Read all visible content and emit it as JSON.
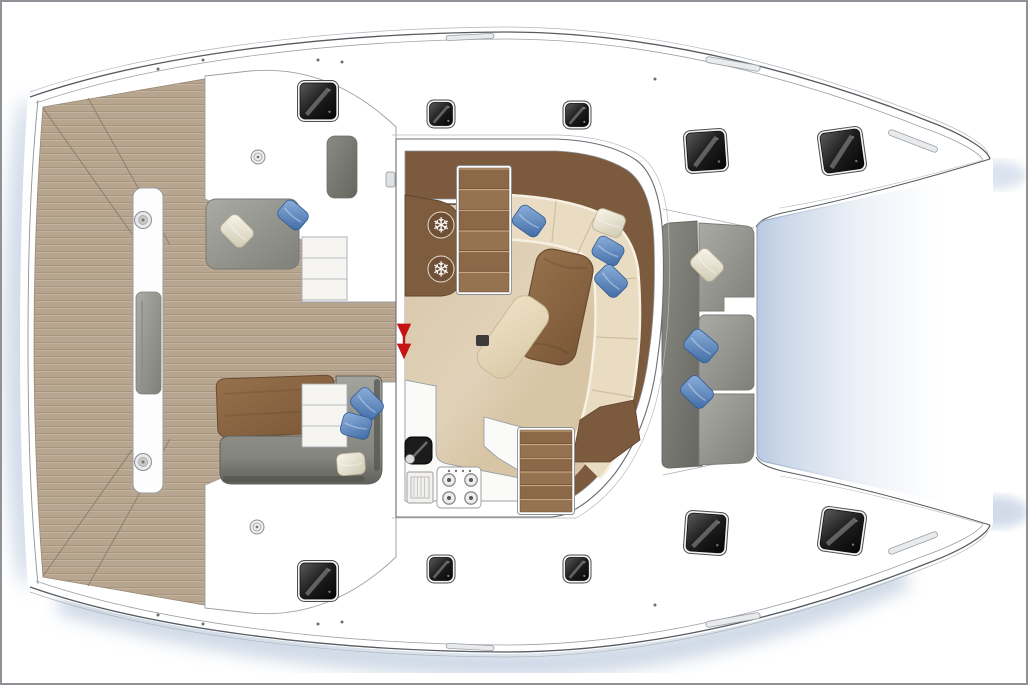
{
  "meta": {
    "title": "catamaran-deck-floor-plan",
    "view": "top-down plan, bow to the right",
    "canvas": {
      "width": 1028,
      "height": 685,
      "frame_color": "#8e9296"
    }
  },
  "palette": {
    "hull_white": "#ffffff",
    "outline_dark": "#565b60",
    "outline_soft": "#9aa0a6",
    "outline_faint": "#b6bbc0",
    "teak": "#b7a58f",
    "teak_line": "#a5947e",
    "teak_seam": "#8f7f6b",
    "salon_floor": "#d8c5a5",
    "wood_band": "#7b5a3d",
    "wood_cabinet": "#7e5d3f",
    "table_wood_hi": "#96714c",
    "table_wood_lo": "#7a5737",
    "step_wood": "#8d6a47",
    "step_wood_dark": "#6a4c32",
    "sofa_cream": "#e9dcc2",
    "sofa_piping": "#f7f1e3",
    "sofa_seam": "#cfbf9f",
    "gray_seat_hi": "#aaaba4",
    "gray_seat_lo": "#7f807a",
    "gray_back_hi": "#8a8b84",
    "gray_back_lo": "#65665f",
    "pillow_blue_hi": "#8fb2dd",
    "pillow_blue_lo": "#3e69a4",
    "pillow_white_hi": "#faf6ea",
    "pillow_white_lo": "#cfc9b2",
    "tramp_edge": "#b9c9e0",
    "water_shadow": "#a9bbd4",
    "hatch_frame": "#f0f0f0",
    "galley_white": "#fafaf8",
    "arrow_red": "#c41414"
  },
  "icons": {
    "snowflake": "❄"
  },
  "zones": [
    {
      "name": "aft-platform-beam"
    },
    {
      "name": "aft-cockpit-teak"
    },
    {
      "name": "cockpit-lounge-port"
    },
    {
      "name": "cockpit-dining-starboard"
    },
    {
      "name": "salon"
    },
    {
      "name": "galley"
    },
    {
      "name": "fridge-freezer-cabinet"
    },
    {
      "name": "forward-cockpit-bench"
    },
    {
      "name": "trampoline"
    },
    {
      "name": "hull-deck-top"
    },
    {
      "name": "hull-deck-bottom"
    }
  ],
  "hatches": [
    {
      "x": 318,
      "y": 101,
      "s": 36,
      "r": 0
    },
    {
      "x": 441,
      "y": 114,
      "s": 23,
      "r": 0
    },
    {
      "x": 577,
      "y": 115,
      "s": 23,
      "r": 0
    },
    {
      "x": 706,
      "y": 151,
      "s": 38,
      "r": -4
    },
    {
      "x": 842,
      "y": 151,
      "s": 40,
      "r": -8
    },
    {
      "x": 318,
      "y": 581,
      "s": 36,
      "r": 0
    },
    {
      "x": 441,
      "y": 569,
      "s": 23,
      "r": 0
    },
    {
      "x": 577,
      "y": 569,
      "s": 23,
      "r": 0
    },
    {
      "x": 706,
      "y": 533,
      "s": 38,
      "r": 4
    },
    {
      "x": 842,
      "y": 531,
      "s": 40,
      "r": 8
    }
  ],
  "pillows": [
    {
      "x": 237,
      "y": 231,
      "s": 30,
      "r": 45,
      "c": "white"
    },
    {
      "x": 293,
      "y": 215,
      "s": 28,
      "r": 40,
      "c": "blue"
    },
    {
      "x": 529,
      "y": 221,
      "s": 30,
      "r": 35,
      "c": "blue"
    },
    {
      "x": 609,
      "y": 223,
      "s": 30,
      "r": 20,
      "c": "white"
    },
    {
      "x": 608,
      "y": 251,
      "s": 29,
      "r": 30,
      "c": "blue"
    },
    {
      "x": 611,
      "y": 281,
      "s": 30,
      "r": 45,
      "c": "blue"
    },
    {
      "x": 367,
      "y": 404,
      "s": 30,
      "r": 45,
      "c": "blue"
    },
    {
      "x": 356,
      "y": 426,
      "s": 29,
      "r": 15,
      "c": "blue"
    },
    {
      "x": 351,
      "y": 464,
      "s": 28,
      "r": -5,
      "c": "white"
    },
    {
      "x": 707,
      "y": 265,
      "s": 30,
      "r": 45,
      "c": "white"
    },
    {
      "x": 701,
      "y": 346,
      "s": 31,
      "r": 40,
      "c": "blue"
    },
    {
      "x": 697,
      "y": 392,
      "s": 30,
      "r": 45,
      "c": "blue"
    }
  ],
  "snowflakes": {
    "positions": [
      [
        441,
        225
      ],
      [
        441,
        269
      ]
    ],
    "size": 21,
    "halo_r": 13
  },
  "burners": {
    "positions": [
      [
        449,
        480
      ],
      [
        471,
        480
      ],
      [
        449,
        498
      ],
      [
        471,
        498
      ]
    ],
    "ring_r": 6.2,
    "dot_r": 2
  },
  "stove_knobs": [
    [
      449,
      471
    ],
    [
      456,
      471
    ],
    [
      463,
      471
    ],
    [
      470,
      471
    ]
  ],
  "drains": [
    [
      258,
      157
    ],
    [
      257,
      527
    ]
  ],
  "beam_ports": [
    [
      143,
      220
    ],
    [
      143,
      462
    ]
  ],
  "deck_tracks": [
    {
      "x": 470,
      "y": 37,
      "w": 48,
      "h": 5,
      "r": -3
    },
    {
      "x": 733,
      "y": 64,
      "w": 55,
      "h": 6,
      "r": 10
    },
    {
      "x": 913,
      "y": 141,
      "w": 52,
      "h": 6,
      "r": 21
    },
    {
      "x": 470,
      "y": 647,
      "w": 48,
      "h": 5,
      "r": 3
    },
    {
      "x": 733,
      "y": 620,
      "w": 55,
      "h": 6,
      "r": -10
    },
    {
      "x": 913,
      "y": 543,
      "w": 52,
      "h": 6,
      "r": -21
    }
  ],
  "deck_dots": [
    [
      203,
      60
    ],
    [
      318,
      60
    ],
    [
      342,
      62
    ],
    [
      158,
      69
    ],
    [
      655,
      79
    ],
    [
      203,
      624
    ],
    [
      318,
      624
    ],
    [
      342,
      622
    ],
    [
      158,
      615
    ],
    [
      655,
      605
    ]
  ],
  "door_arrow": {
    "x": 404,
    "y1": 328,
    "y2": 356
  },
  "stairs": [
    {
      "name": "salon-entry-steps",
      "x": 459,
      "y": 168,
      "w": 50,
      "h": 124,
      "treads": 6,
      "style": "wood"
    },
    {
      "name": "galley-hull-steps",
      "x": 520,
      "y": 430,
      "w": 52,
      "h": 82,
      "treads": 6,
      "style": "wood"
    },
    {
      "name": "cockpit-side-steps-top",
      "x": 302,
      "y": 237,
      "w": 45,
      "h": 63,
      "treads": 3,
      "style": "white"
    },
    {
      "name": "cockpit-side-steps-bottom",
      "x": 302,
      "y": 384,
      "w": 45,
      "h": 63,
      "treads": 3,
      "style": "white"
    }
  ]
}
